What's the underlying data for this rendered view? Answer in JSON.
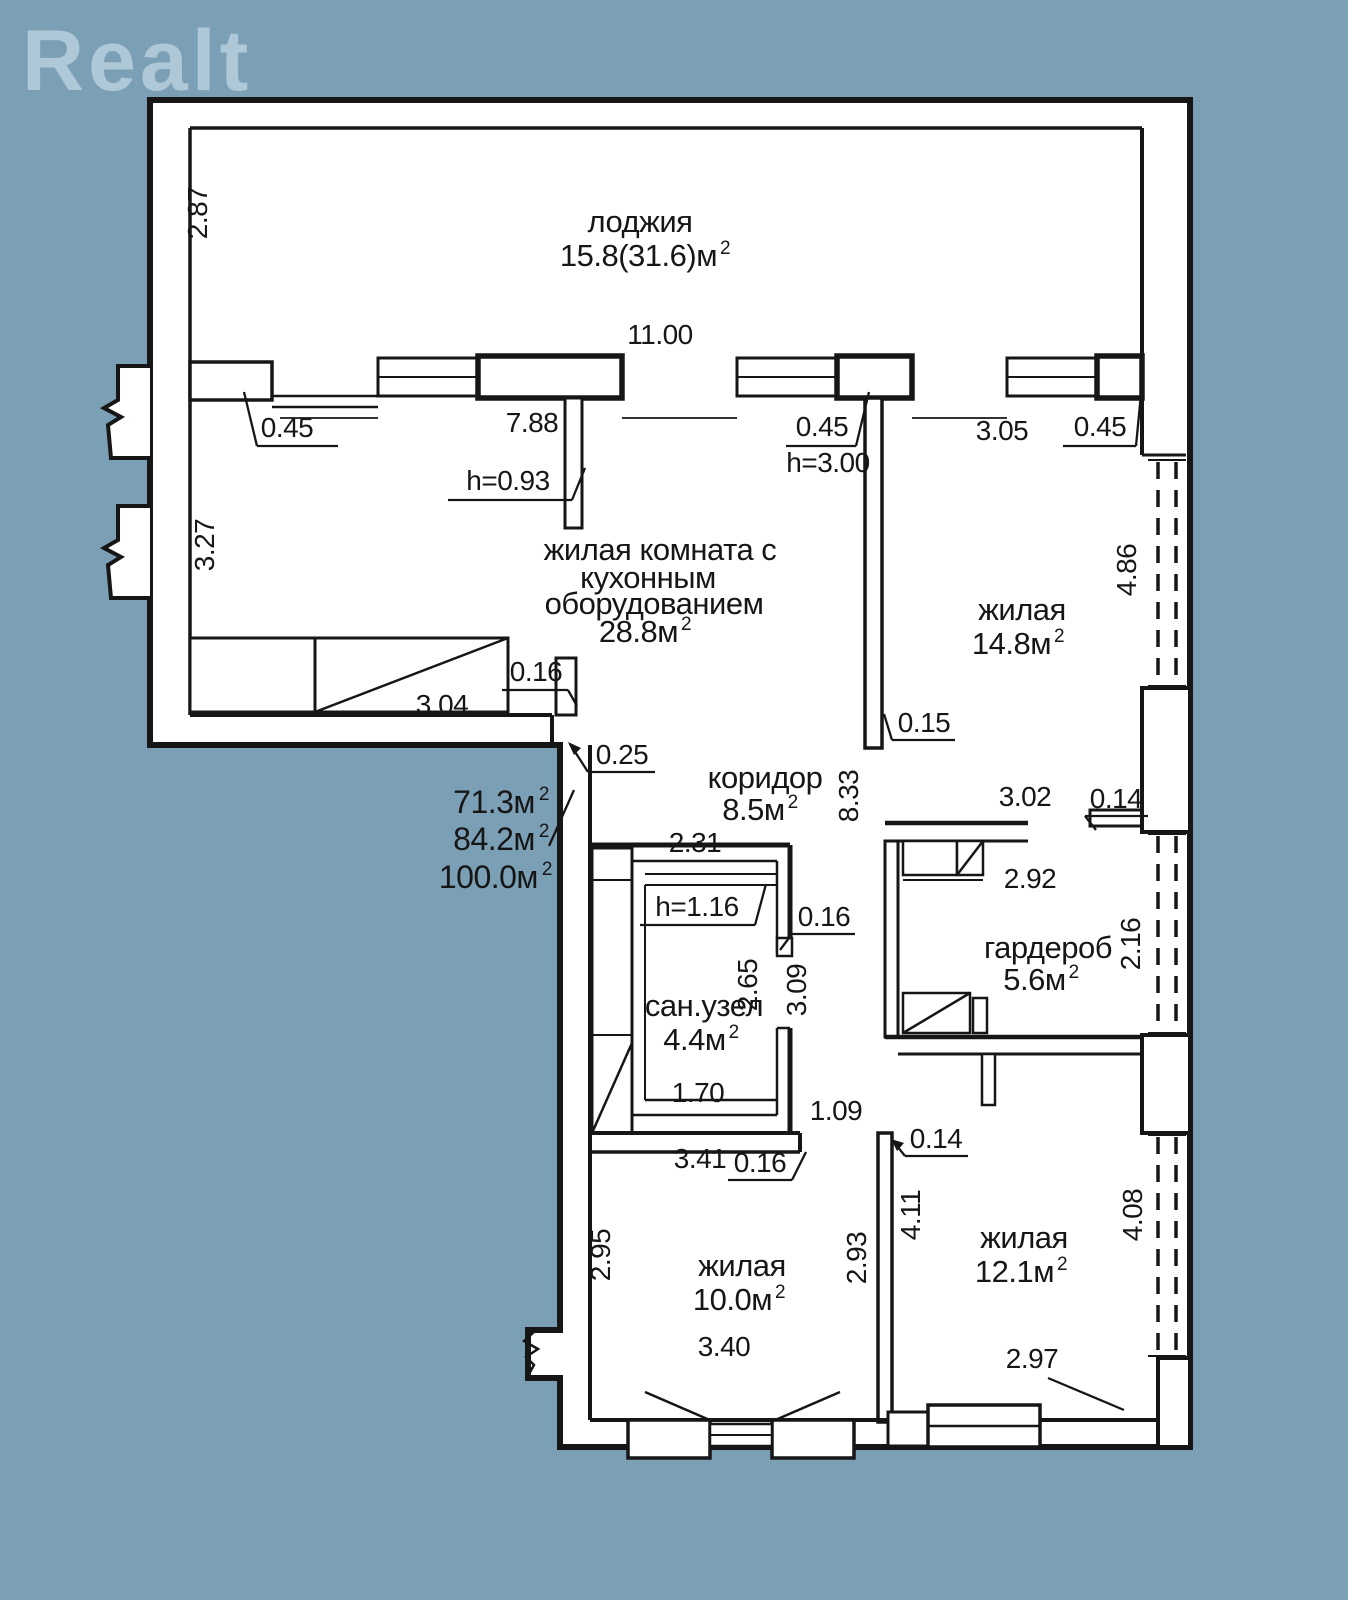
{
  "logo": {
    "text": "Realt"
  },
  "colors": {
    "background": "#7BA0B6",
    "paper": "#FFFFFF",
    "line": "#161616",
    "watermark": "#AFC8D7"
  },
  "rooms": {
    "loggia": {
      "name": "лоджия",
      "area": "15.8(31.6)м",
      "sup": "2"
    },
    "living_kitchen": {
      "line1": "жилая комната с",
      "line2": "кухонным",
      "line3": "оборудованием",
      "area": "28.8м",
      "sup": "2"
    },
    "living_14": {
      "name": "жилая",
      "area": "14.8м",
      "sup": "2"
    },
    "corridor": {
      "name": "коридор",
      "area": "8.5м",
      "sup": "2"
    },
    "bathroom": {
      "name": "сан.узел",
      "area": "4.4м",
      "sup": "2"
    },
    "wardrobe": {
      "name": "гардероб",
      "area": "5.6м",
      "sup": "2"
    },
    "living_10": {
      "name": "жилая",
      "area": "10.0м",
      "sup": "2"
    },
    "living_12": {
      "name": "жилая",
      "area": "12.1м",
      "sup": "2"
    }
  },
  "totals": [
    {
      "value": "71.3м",
      "sup": "2"
    },
    {
      "value": "84.2м",
      "sup": "2"
    },
    {
      "value": "100.0м",
      "sup": "2"
    }
  ],
  "dimensions": [
    {
      "t": "2.87",
      "x": 207,
      "y": 213,
      "rot": true
    },
    {
      "t": "11.00",
      "x": 660,
      "y": 344
    },
    {
      "t": "0.45",
      "x": 287,
      "y": 437
    },
    {
      "t": "7.88",
      "x": 532,
      "y": 432
    },
    {
      "t": "h=0.93",
      "x": 508,
      "y": 490
    },
    {
      "t": "0.45",
      "x": 822,
      "y": 436
    },
    {
      "t": "h=3.00",
      "x": 828,
      "y": 472
    },
    {
      "t": "3.05",
      "x": 1002,
      "y": 440
    },
    {
      "t": "0.45",
      "x": 1100,
      "y": 436
    },
    {
      "t": "3.27",
      "x": 214,
      "y": 545,
      "rot": true
    },
    {
      "t": "4.86",
      "x": 1136,
      "y": 570,
      "rot": true
    },
    {
      "t": "0.16",
      "x": 536,
      "y": 681
    },
    {
      "t": "3.04",
      "x": 442,
      "y": 714
    },
    {
      "t": "0.25",
      "x": 622,
      "y": 764
    },
    {
      "t": "0.15",
      "x": 924,
      "y": 732
    },
    {
      "t": "8.33",
      "x": 858,
      "y": 796,
      "rot": true
    },
    {
      "t": "3.02",
      "x": 1025,
      "y": 806
    },
    {
      "t": "0.14",
      "x": 1116,
      "y": 808
    },
    {
      "t": "2.92",
      "x": 1030,
      "y": 888
    },
    {
      "t": "2.16",
      "x": 1140,
      "y": 944,
      "rot": true
    },
    {
      "t": "2.31",
      "x": 695,
      "y": 852
    },
    {
      "t": "h=1.16",
      "x": 697,
      "y": 916
    },
    {
      "t": "0.16",
      "x": 824,
      "y": 926
    },
    {
      "t": "2.65",
      "x": 757,
      "y": 985,
      "rot": true
    },
    {
      "t": "3.09",
      "x": 806,
      "y": 990,
      "rot": true
    },
    {
      "t": "1.70",
      "x": 698,
      "y": 1102
    },
    {
      "t": "1.09",
      "x": 836,
      "y": 1120
    },
    {
      "t": "3.41",
      "x": 700,
      "y": 1168
    },
    {
      "t": "0.16",
      "x": 760,
      "y": 1172
    },
    {
      "t": "0.14",
      "x": 936,
      "y": 1148
    },
    {
      "t": "2.95",
      "x": 610,
      "y": 1255,
      "rot": true
    },
    {
      "t": "2.93",
      "x": 866,
      "y": 1258,
      "rot": true
    },
    {
      "t": "4.11",
      "x": 920,
      "y": 1215,
      "rot": true
    },
    {
      "t": "4.08",
      "x": 1142,
      "y": 1215,
      "rot": true
    },
    {
      "t": "3.40",
      "x": 724,
      "y": 1356
    },
    {
      "t": "2.97",
      "x": 1032,
      "y": 1368
    }
  ]
}
